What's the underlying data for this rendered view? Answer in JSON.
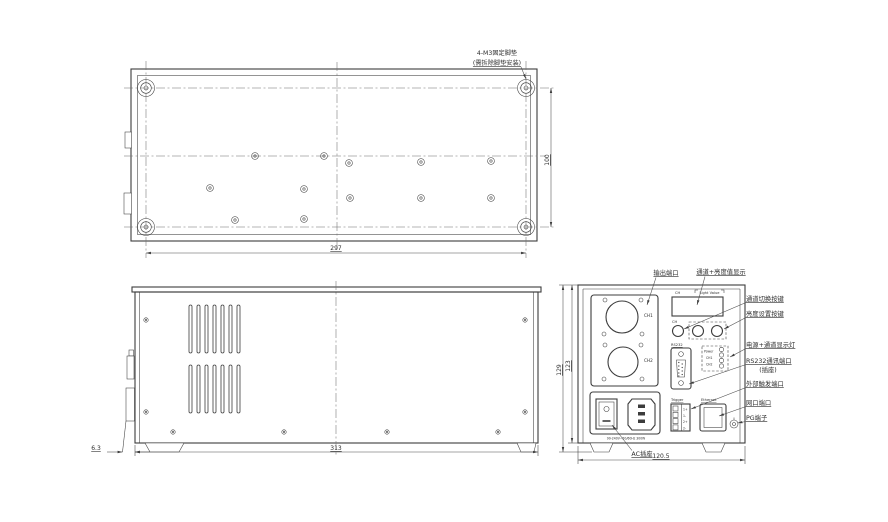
{
  "top_view": {
    "note_line1": "4-M3固定脚垫",
    "note_line2": "(需拆除脚垫安装)",
    "dim_width": "297",
    "dim_depth": "100"
  },
  "side_view": {
    "dim_length": "313",
    "dim_foot": "6.3"
  },
  "rear_view": {
    "dim_width": "120.5",
    "dim_height_outer": "129",
    "dim_height_inner": "123",
    "callouts": {
      "output_port": "输出端口",
      "display": "通道+亮度值显示",
      "channel_switch_key": "通道切换按键",
      "brightness_key": "亮度设置按键",
      "indicator_leds": "电源+通道显示灯",
      "rs232_line1": "RS232通讯端口",
      "rs232_line2": "(插座)",
      "trigger_port": "外部触发端口",
      "lan_port": "网口端口",
      "pg_terminal": "PG端子",
      "ac_socket": "AC插座"
    },
    "panel": {
      "display_ch": "CH",
      "display_value": "Light Value",
      "ch_button": "CH",
      "ch1": "CH1",
      "ch2": "CH2",
      "rs232": "RS232",
      "led_power": "Power",
      "led_ch1": "CH1",
      "led_ch2": "CH2",
      "trigger": "Trigger",
      "ethernet": "Ethernet",
      "trigger_pins": [
        "1+",
        "1-",
        "2+",
        "2-"
      ],
      "ac_rating": "90-240V~50/60Hz 300W"
    }
  }
}
